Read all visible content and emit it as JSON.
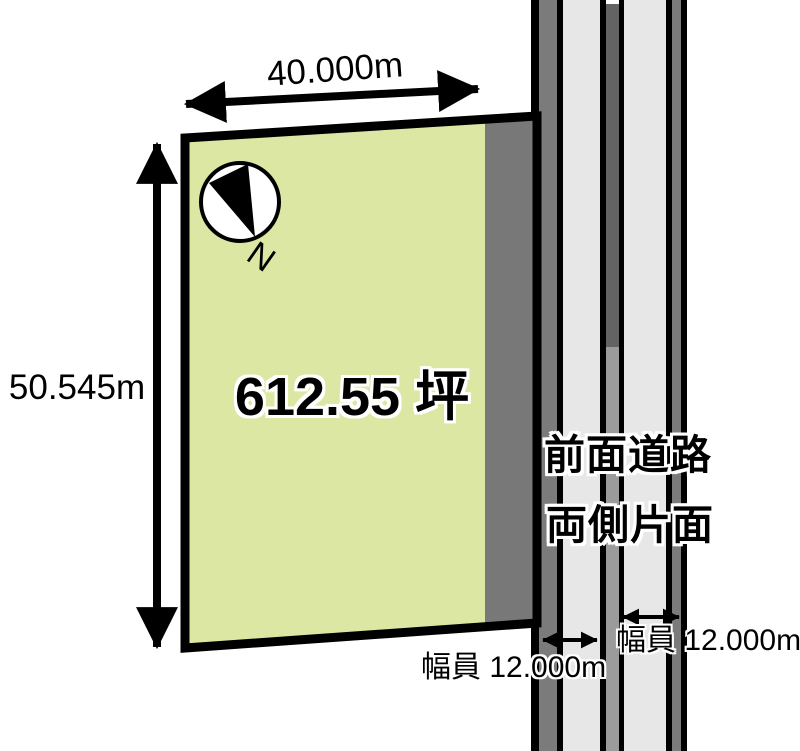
{
  "diagram": {
    "type": "land-plot-plan",
    "parcel": {
      "width_label": "40.000m",
      "depth_label": "50.545m",
      "area_label": "612.55 坪"
    },
    "compass": {
      "north_label": "N"
    },
    "road": {
      "note_line1": "前面道路",
      "note_line2": "両側片面",
      "width_label_left": "幅員 12.000m",
      "width_label_right": "幅員 12.000m"
    },
    "colors": {
      "parcel_fill": "#dce7a3",
      "parcel_strip": "#787878",
      "road_black": "#000000",
      "road_shoulder": "#7b7b7b",
      "road_lane": "#e7e7e7",
      "road_median_dark": "#636363",
      "road_median_light": "#9b9b9b",
      "background": "#ffffff"
    }
  }
}
